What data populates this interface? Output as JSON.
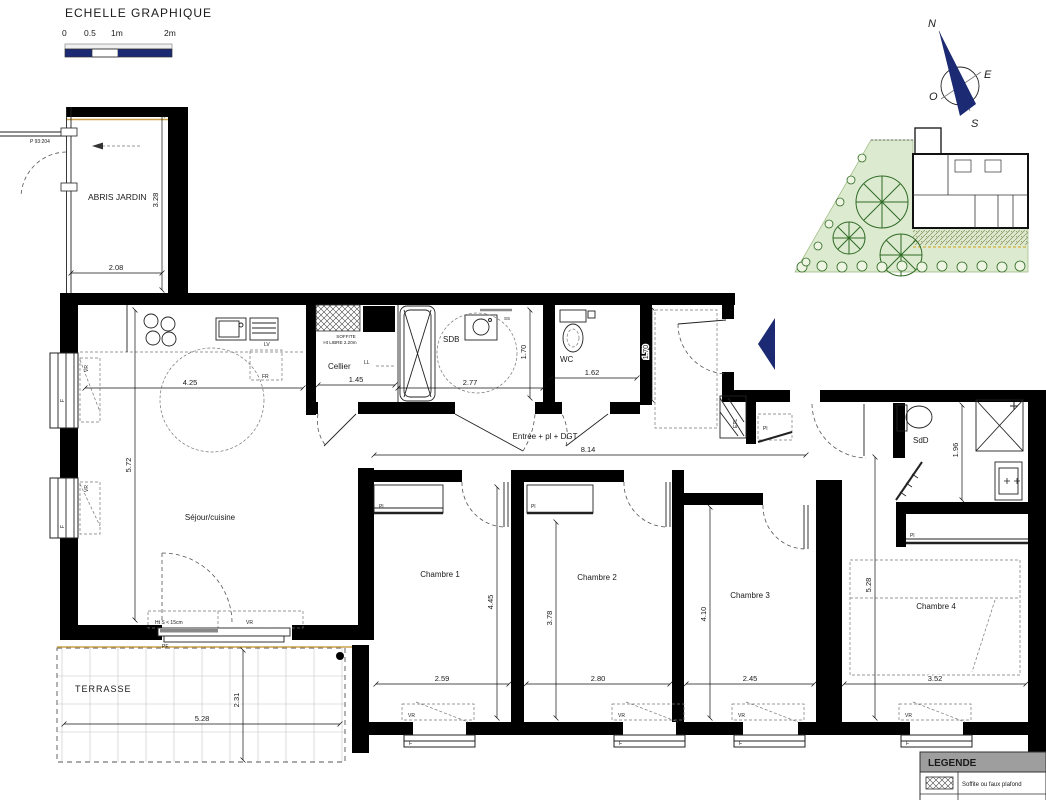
{
  "scale_bar": {
    "title": "ECHELLE GRAPHIQUE",
    "ticks": {
      "t0": "0",
      "t05": "0.5",
      "t1": "1m",
      "t2": "2m"
    }
  },
  "compass": {
    "n": "N",
    "e": "E",
    "s": "S",
    "o": "O"
  },
  "site_ref": "P 93:204",
  "rooms": {
    "abris": {
      "name": "ABRIS JARDIN",
      "dim_w": "2.08",
      "dim_h": "3.28"
    },
    "sejour": {
      "name": "Séjour/cuisine",
      "dim_w": "4.25",
      "dim_h": "5.72"
    },
    "cellier": {
      "name": "Cellier",
      "dim_w": "1.45"
    },
    "sdb": {
      "name": "SDB",
      "dim_w": "2.77",
      "dim_h": "1.70"
    },
    "wc": {
      "name": "WC",
      "dim_w": "1.62",
      "dim_h": "1.70"
    },
    "entree": {
      "name": "Entrée + pl + DGT",
      "dim_w": "8.14"
    },
    "sdd": {
      "name": "SdD",
      "dim_h": "1.96"
    },
    "ch1": {
      "name": "Chambre 1",
      "dim_w": "2.59",
      "dim_h": "4.45"
    },
    "ch2": {
      "name": "Chambre 2",
      "dim_w": "2.80",
      "dim_h": "3.78"
    },
    "ch3": {
      "name": "Chambre 3",
      "dim_w": "2.45",
      "dim_h": "4.10"
    },
    "ch4": {
      "name": "Chambre 4",
      "dim_w": "3.52",
      "dim_h": "5.28"
    },
    "terrasse": {
      "name": "TERRASSE",
      "dim_w": "5.28",
      "dim_h": "2.31"
    }
  },
  "tags": {
    "vr": "VR",
    "f": "F",
    "pf": "PF",
    "pl": "Pl",
    "ll": "LL",
    "lv": "LV",
    "fr": "FR",
    "etl": "ETL",
    "ss": "SS",
    "soffite_l1": "SOFFITE",
    "soffite_l2": "Ht LIBRE 2.20m",
    "ht_s": "Ht S < 15cm"
  },
  "legend": {
    "title": "LEGENDE",
    "rows": [
      {
        "key": "hatch",
        "label": "Soffite ou faux plafond"
      },
      {
        "key": "F",
        "label": "Fenêtre"
      }
    ]
  },
  "colors": {
    "navy": "#1b2a72",
    "wall": "#000000",
    "site_green": "#dcead0",
    "tree_green": "#2f6b25",
    "tan": "#c9a24b"
  }
}
